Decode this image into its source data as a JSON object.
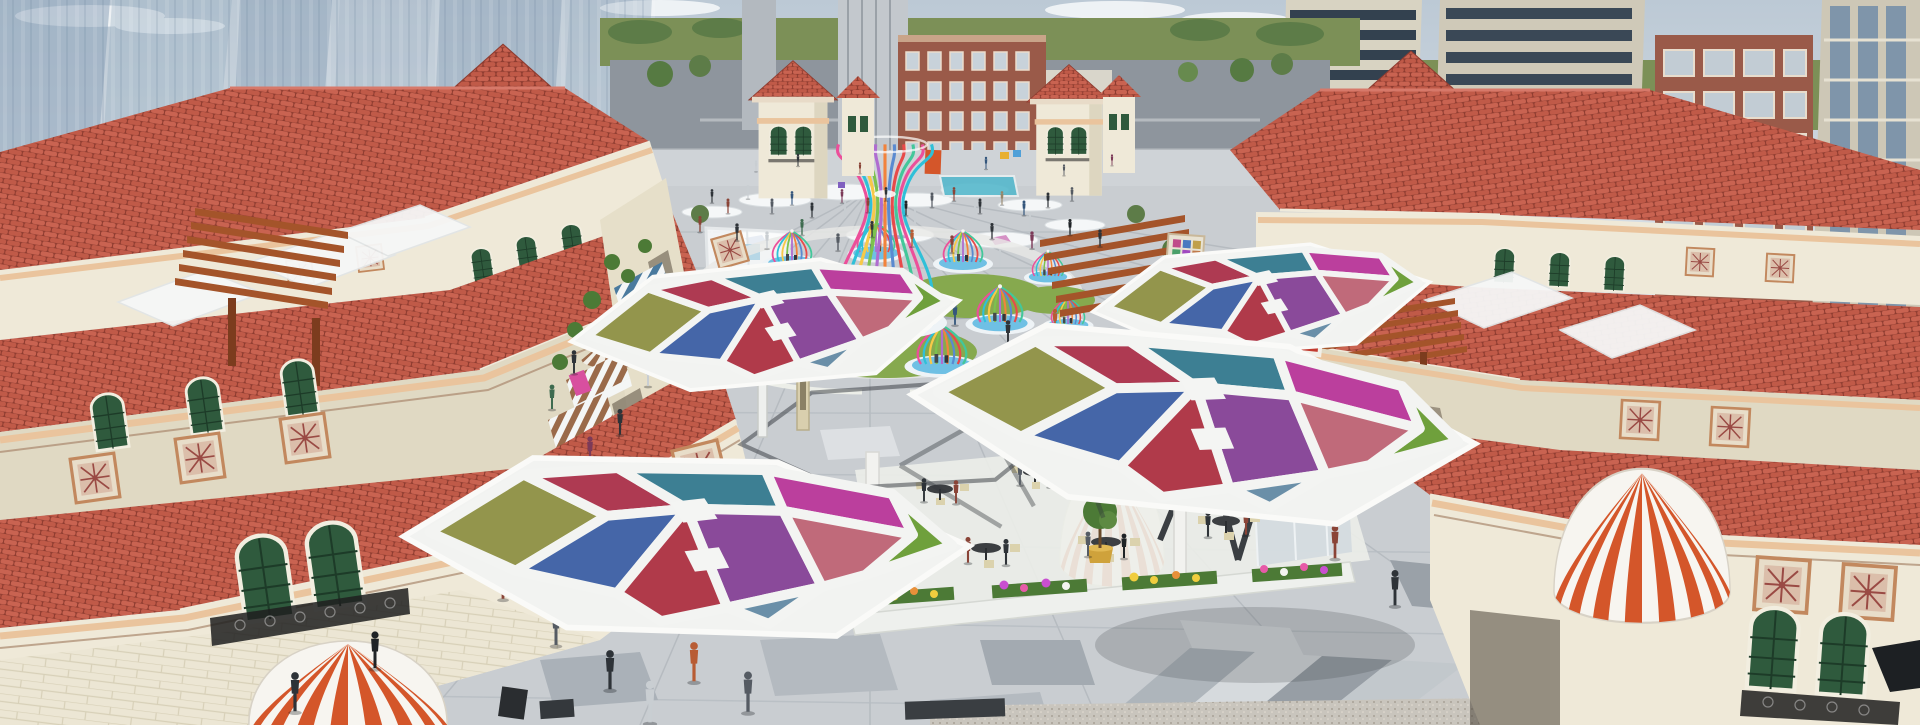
{
  "meta": {
    "title": "Aerial architectural rendering of a Mediterranean-style open-air retail plaza",
    "scene_type": "3d-architectural-visualization",
    "view": "elevated aerial view down a pedestrian shopping street toward a cross street"
  },
  "palette": {
    "sky_top": "#bcc9d5",
    "sky_bottom": "#e9edf0",
    "glass_tower": "#8ba2b8",
    "apartment_wall": "#d8d3c2",
    "apartment_window": "#33414f",
    "brick": "#9a5a49",
    "grass_horizon": "#7c9057",
    "tree_green": "#567a42",
    "tree_light": "#78975e",
    "road": "#8e959d",
    "roof_tile": "#c96351",
    "roof_tile_dark": "#8e3c30",
    "roof_highlight": "#d7796a",
    "wall_cream": "#efe9d8",
    "wall_shade": "#e0d9c3",
    "trim_peach": "#eac49d",
    "window_green": "#2f5a3d",
    "iron_black": "#1e1e1e",
    "pergola_wood": "#a4542a",
    "pergola_dark": "#7c3c1e",
    "paving": "#c9cdd1",
    "paving_dark": "#9aa1a8",
    "paving_mid": "#b4bac0",
    "paving_light": "#dde0e3",
    "granite": "#c9c5bd",
    "plank": "#d9cfae",
    "shadow": "#2f343a",
    "awning_blue": "#4a7a9e",
    "awning_cyan": "#49b8d8",
    "awning_brown": "#9a6a4a",
    "awning_orange": "#d4562a",
    "canvas_white": "#f6f4ef",
    "pool": "#6fc0e4",
    "lawn": "#86a94e",
    "cafe_floor": "#eceee9",
    "table_dark": "#3c3f42",
    "chair_cream": "#dbd2ad",
    "pot_gold": "#cfa23b",
    "sign_pink": "#d84f9f",
    "sign_red": "#c23b30",
    "flower_pink": "#e75aa8",
    "flower_yellow": "#f0cd3e",
    "flower_magenta": "#c94fd0",
    "flower_white": "#f3f4f0",
    "leaf": "#4c7a36",
    "panels": [
      "#93954c",
      "#ae3a52",
      "#3d7f93",
      "#bb3f9d",
      "#6fa03c",
      "#4566a8",
      "#8a4a9a",
      "#c06a7a",
      "#b03a4a",
      "#6a8fa8"
    ],
    "ribbons": [
      "#ec4f9a",
      "#2fc0d8",
      "#f7c948",
      "#7cc24f",
      "#b06cd0",
      "#f2833c",
      "#5a8ad0",
      "#e84a4a",
      "#43c79a"
    ]
  },
  "scene": {
    "background": [
      "glass high-rise towers (left)",
      "apartment towers (right)",
      "brick mid-rise block",
      "green tree horizon",
      "cross street"
    ],
    "street_architecture": [
      "red clay tile roofs",
      "cream stucco facades",
      "campanile towers with pyramidal tile roofs",
      "timber pergolas",
      "striped shop awnings",
      "decorative ceramic tile panels",
      "green shuttered arch windows",
      "wrought-iron balconies"
    ],
    "plaza_features": [
      "rainbow ribbon birdcage pavilions on blue pools",
      "white tensile umbrella canopies",
      "stained-glass hexagonal shade canopies",
      "outdoor cafe seating",
      "flower beds",
      "striped dome awnings",
      "topiary planters",
      "crowds of pedestrians"
    ],
    "canopy_count": 4,
    "birdcage_count": 9,
    "dome_awning_count": 3,
    "campanile_count": 6
  },
  "crowd": {
    "colors": [
      "#2e3338",
      "#555b63",
      "#8a4437",
      "#34567c",
      "#7c3a58",
      "#c9ced2",
      "#1f2326",
      "#97866a",
      "#3e6b4f",
      "#b85c34"
    ],
    "people": [
      [
        756,
        166,
        0.45,
        5
      ],
      [
        798,
        160,
        0.5,
        0
      ],
      [
        860,
        168,
        0.45,
        2
      ],
      [
        986,
        163,
        0.5,
        3
      ],
      [
        1064,
        170,
        0.45,
        1
      ],
      [
        1112,
        160,
        0.45,
        4
      ],
      [
        712,
        196,
        0.55,
        0
      ],
      [
        728,
        206,
        0.6,
        2
      ],
      [
        748,
        192,
        0.55,
        5
      ],
      [
        772,
        206,
        0.6,
        1
      ],
      [
        792,
        198,
        0.55,
        3
      ],
      [
        812,
        210,
        0.6,
        0
      ],
      [
        842,
        196,
        0.55,
        4
      ],
      [
        868,
        205,
        0.6,
        2
      ],
      [
        886,
        194,
        0.55,
        0
      ],
      [
        906,
        208,
        0.6,
        6
      ],
      [
        932,
        200,
        0.6,
        1
      ],
      [
        954,
        194,
        0.55,
        2
      ],
      [
        980,
        206,
        0.6,
        0
      ],
      [
        1002,
        198,
        0.55,
        7
      ],
      [
        1024,
        208,
        0.6,
        3
      ],
      [
        1048,
        200,
        0.6,
        0
      ],
      [
        1072,
        194,
        0.55,
        1
      ],
      [
        700,
        224,
        0.65,
        2
      ],
      [
        737,
        232,
        0.7,
        0
      ],
      [
        767,
        240,
        0.7,
        5
      ],
      [
        802,
        227,
        0.65,
        8
      ],
      [
        838,
        242,
        0.7,
        1
      ],
      [
        872,
        229,
        0.65,
        0
      ],
      [
        912,
        238,
        0.7,
        9
      ],
      [
        952,
        244,
        0.7,
        2
      ],
      [
        992,
        231,
        0.65,
        0
      ],
      [
        1032,
        240,
        0.7,
        4
      ],
      [
        1070,
        227,
        0.65,
        6
      ],
      [
        1100,
        238,
        0.7,
        0
      ],
      [
        642,
        302,
        0.9,
        0
      ],
      [
        667,
        324,
        0.95,
        2
      ],
      [
        692,
        348,
        1,
        1
      ],
      [
        648,
        374,
        1,
        5
      ],
      [
        955,
        314,
        0.9,
        3
      ],
      [
        1008,
        332,
        0.95,
        0
      ],
      [
        1055,
        320,
        0.9,
        9
      ],
      [
        1098,
        348,
        1,
        2
      ],
      [
        1133,
        365,
        1.05,
        0
      ],
      [
        1163,
        332,
        0.95,
        6
      ],
      [
        620,
        422,
        1.05,
        0
      ],
      [
        590,
        450,
        1.1,
        4
      ],
      [
        1124,
        397,
        1,
        1
      ],
      [
        1158,
        422,
        1.05,
        0
      ],
      [
        1194,
        454,
        1.1,
        2
      ],
      [
        1234,
        472,
        1.15,
        7
      ],
      [
        988,
        370,
        0.95,
        0
      ],
      [
        1024,
        394,
        1,
        5
      ],
      [
        600,
        332,
        0.9,
        1
      ],
      [
        574,
        362,
        0.95,
        0
      ],
      [
        552,
        397,
        1,
        8
      ],
      [
        1208,
        317,
        0.9,
        0
      ],
      [
        1230,
        340,
        0.95,
        3
      ],
      [
        1260,
        364,
        1,
        1
      ],
      [
        1288,
        392,
        1.05,
        0
      ],
      [
        1318,
        427,
        1.1,
        2
      ],
      [
        458,
        542,
        1.35,
        0
      ],
      [
        503,
        582,
        1.4,
        2
      ],
      [
        556,
        627,
        1.5,
        1
      ],
      [
        610,
        670,
        1.6,
        0
      ],
      [
        650,
        702,
        1.7,
        5
      ],
      [
        375,
        650,
        1.5,
        6
      ],
      [
        295,
        692,
        1.6,
        0
      ],
      [
        1335,
        542,
        1.35,
        2
      ],
      [
        1395,
        588,
        1.45,
        0
      ],
      [
        748,
        692,
        1.65,
        1
      ],
      [
        694,
        662,
        1.6,
        9
      ],
      [
        924,
        490,
        0.95,
        0
      ],
      [
        956,
        492,
        0.95,
        2
      ],
      [
        1020,
        474,
        0.9,
        1
      ],
      [
        1050,
        476,
        0.9,
        5
      ],
      [
        1110,
        466,
        0.9,
        0
      ],
      [
        1140,
        468,
        0.9,
        3
      ],
      [
        968,
        550,
        1.05,
        2
      ],
      [
        1006,
        552,
        1.05,
        0
      ],
      [
        1088,
        544,
        1,
        1
      ],
      [
        1124,
        546,
        1,
        6
      ],
      [
        1208,
        524,
        1.05,
        0
      ],
      [
        1246,
        522,
        1.05,
        2
      ],
      [
        1292,
        476,
        0.95,
        4
      ]
    ]
  }
}
